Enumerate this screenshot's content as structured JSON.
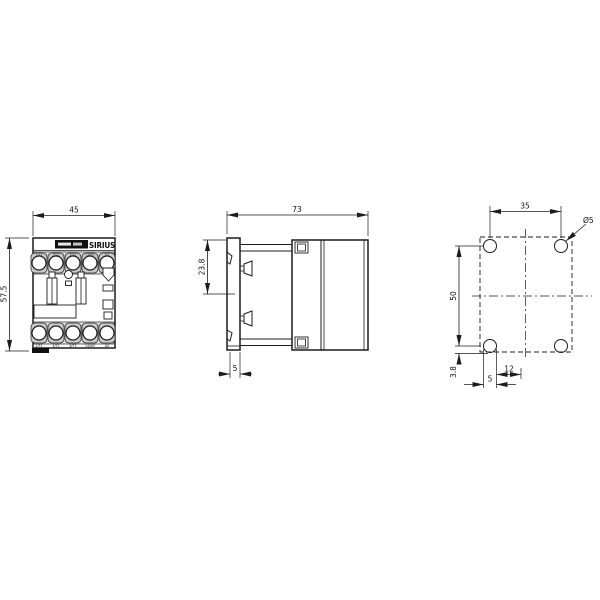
{
  "front_view": {
    "width_dim": "45",
    "height_dim": "57.5",
    "brand": "SIRIUS",
    "top_terminals": [
      "1/L1",
      "3/L2",
      "5/L3",
      "13/NO",
      "A1"
    ],
    "bottom_terminals": [
      "2/T1",
      "4/T2",
      "6/T3",
      "14/NO",
      "A2"
    ]
  },
  "side_view": {
    "depth_dim": "73",
    "rail_clip_dim": "23.8",
    "foot_width_dim": "5"
  },
  "mounting_view": {
    "hole_pitch_horizontal": "35",
    "hole_pitch_vertical": "50",
    "hole_diameter": "Ø5",
    "slot_extension_dim": "3.8",
    "offset_dim": "12",
    "slot_width_dim": "5"
  },
  "colors": {
    "line": "#1c1c1c",
    "background": "#ffffff",
    "band_fill": "#e2e2e2"
  }
}
